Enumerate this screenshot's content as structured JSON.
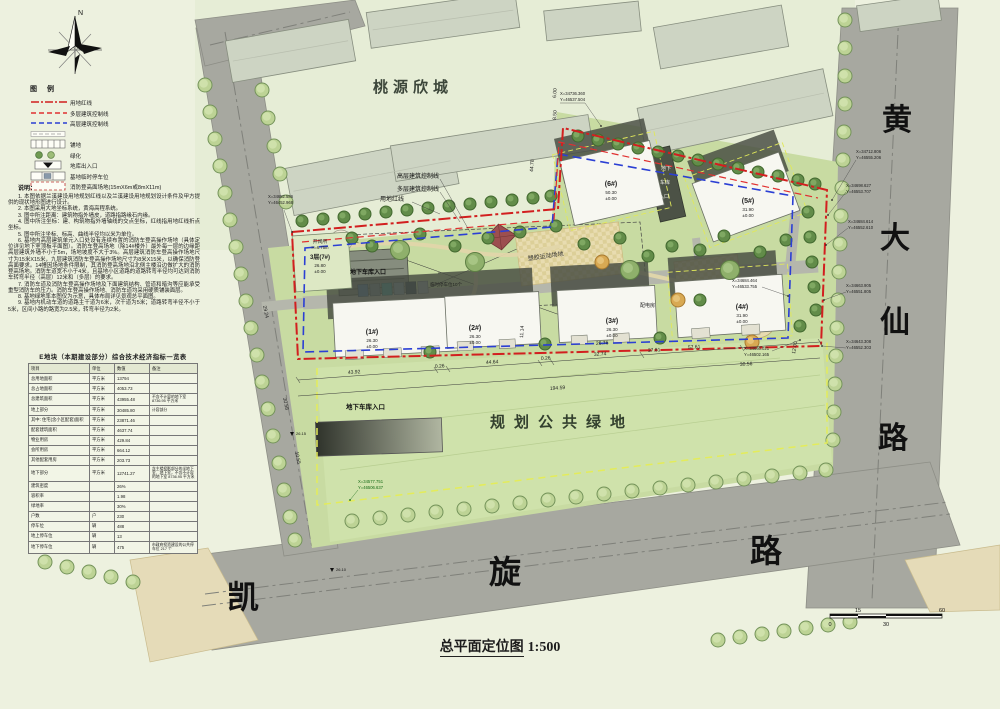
{
  "title": {
    "text": "总平面定位图",
    "scale": "1:500"
  },
  "compass": {
    "north": "N"
  },
  "scalebar": {
    "labels": [
      "0",
      "15",
      "30",
      "60"
    ]
  },
  "legend": {
    "title": "图 例",
    "items": [
      {
        "label": "用地红线",
        "type": "red-dashdot"
      },
      {
        "label": "多层建筑控制线",
        "type": "red-dash"
      },
      {
        "label": "高层建筑控制线",
        "type": "blue-dash"
      },
      {
        "label": "",
        "type": "grey-line"
      },
      {
        "label": "铺地",
        "type": "hatch"
      },
      {
        "label": "绿化",
        "type": "green"
      },
      {
        "label": "地库出入口",
        "type": "entry"
      },
      {
        "label": "基地临时停车位",
        "type": "parking"
      },
      {
        "label": "消防登高面场地(15mX6m或8mX11m)",
        "type": "fire"
      }
    ]
  },
  "notes": {
    "title": "说明：",
    "lines": [
      "1. 本图依据兰溪建设用地规划红线以及兰溪建设用地规划设计条件及甲方提供的现状地形图进行设计。",
      "2. 本图采用大地坐标系统，黄海高程系统。",
      "3. 图中所注距离：建筑物指外墙皮，道路指路缘石内缘。",
      "4. 图中所注坐标：建、构筑物指外墙轴线的交点坐标，红线指用地红线折点坐标。",
      "5. 图中所注坐标、标高、曲线半径均以米为单位。",
      "6. 基地内高层建筑单元入口处设有连续布置的消防车登高操作场地（具体定位详见地下室顶板平面图）。消防车登高场地（除14#楼外）最外每一层的边缘距高层建筑外墙不小于5m，场地坡度不大于3%。高层建筑消防车登高操作场地尺寸为15米X15米，九层建筑消防车登高操作场地尺寸为8米X15米，以确保消防登高面要求。14幢因场地条件限制，其消防登高场地沿北侧主楼沿边做扩大的消防登高场地。消防车道宽不小于4米，且基地小区道路的道路转弯半径均可达到消防车转弯半径（高层）12米和（多层）的要求。",
      "7. 消防车道及消防车登高操作场地及下面建筑结构、管道和暗沟等应能承受重型消防车的压力。消防车登高操作场地、消防车道均采用硬质铺装面层。",
      "8. 基地绿地率本图仅为示意，具体布局详见景观总平面图。",
      "9. 基地内机动车道的道路主干道为6米，次干道为5米；道路转弯半径不小于5米，区间小路的路宽为2.5米，转弯半径为2米。"
    ]
  },
  "table": {
    "title": "E地块（本期建设部分）综合技术经济指标一览表",
    "headers": [
      "项目",
      "单位",
      "数值",
      "备注"
    ],
    "rows": [
      {
        "name": "总用地面积",
        "unit": "平方米",
        "value": "13794",
        "remark": ""
      },
      {
        "name": "总占地面积",
        "unit": "平方米",
        "value": "4053.73",
        "remark": ""
      },
      {
        "name": "总建筑面积",
        "unit": "平方米",
        "value": "43955.48",
        "remark": "不含不计容的地下室 8736.95 平方米"
      },
      {
        "name": "地上部分",
        "unit": "平方米",
        "value": "30485.80",
        "remark": "计容部分"
      },
      {
        "name": "其中: 住宅(含小区配套)面积",
        "unit": "平方米",
        "value": "23871.46",
        "remark": ""
      },
      {
        "name": "配套建筑面积",
        "unit": "平方米",
        "value": "4637.74",
        "remark": ""
      },
      {
        "name": "物业用房",
        "unit": "平方米",
        "value": "429.84",
        "remark": ""
      },
      {
        "name": "会所用房",
        "unit": "平方米",
        "value": "664.12",
        "remark": ""
      },
      {
        "name": "其他配套用房",
        "unit": "平方米",
        "value": "203.73",
        "remark": ""
      },
      {
        "name": "地下部分",
        "unit": "平方米",
        "value": "12741.27",
        "remark": "含主楼投影部分的半地下室、地下室，不含不计容的地下室 8736.95 平方米"
      },
      {
        "name": "建筑密度",
        "unit": "",
        "value": "26%",
        "remark": ""
      },
      {
        "name": "容积率",
        "unit": "",
        "value": "1.98",
        "remark": ""
      },
      {
        "name": "绿地率",
        "unit": "",
        "value": "30%",
        "remark": ""
      },
      {
        "name": "户数",
        "unit": "户",
        "value": "230",
        "remark": ""
      },
      {
        "name": "停车位",
        "unit": "辆",
        "value": "488",
        "remark": ""
      },
      {
        "name": "地上停车位",
        "unit": "辆",
        "value": "13",
        "remark": ""
      },
      {
        "name": "地下停车位",
        "unit": "辆",
        "value": "475",
        "remark": "市政府投资建设的公共停车位 217 个"
      }
    ]
  },
  "plan": {
    "labels": {
      "taoyuan": "桃源欣城",
      "public_green": "规划公共绿地",
      "garage1": "地下车库入口",
      "garage2": "地下车库入口",
      "garage3a": "地下",
      "garage3b": "车库",
      "garage3c": "入口",
      "sports": "塑胶运动场地",
      "temp_parking": "临时停车位10个",
      "power_room": "配电房",
      "switch_station": "开闭所",
      "switch_height": "H=6.75m"
    },
    "line_labels": {
      "highrise": "高层建筑控制线",
      "multistorey": "多层建筑控制线",
      "redline": "用地红线"
    },
    "buildings": [
      {
        "no": "(1#)",
        "elev": "26.30",
        "base": "±0.00"
      },
      {
        "no": "(2#)",
        "elev": "26.30",
        "base": "±0.00"
      },
      {
        "no": "(3#)",
        "elev": "26.30",
        "base": "±0.00"
      },
      {
        "no": "(4#)",
        "elev": "31.90",
        "base": "±0.00"
      },
      {
        "no": "(5#)",
        "elev": "31.90",
        "base": "±0.00"
      },
      {
        "no": "(6#)",
        "elev": "50.30",
        "base": "±0.00"
      },
      {
        "no": "3层(7#)",
        "elev": "26.80",
        "base": "±0.00"
      }
    ],
    "roads": {
      "huangdaxian": [
        "黄",
        "大",
        "仙",
        "路"
      ],
      "kaixuan": [
        "凯",
        "旋",
        "路"
      ]
    },
    "coords": {
      "c0": {
        "x": "X=34736.360",
        "y": "Y=46537.504"
      },
      "c1": {
        "x": "X=34712.806",
        "y": "Y=46555.206"
      },
      "c2": {
        "x": "X=34698.627",
        "y": "Y=46553.707"
      },
      "c3": {
        "x": "X=34684.614",
        "y": "Y=46552.610"
      },
      "c4": {
        "x": "X=34663.905",
        "y": "Y=46551.805"
      },
      "c5": {
        "x": "X=34643.308",
        "y": "Y=46552.303"
      },
      "c6": {
        "x": "X=34684.464",
        "y": "Y=46533.755"
      },
      "c7": {
        "x": "X=34666.021",
        "y": "Y=46502.165"
      },
      "c8": {
        "x": "X=34577.751",
        "y": "Y=46506.637"
      },
      "c9": {
        "x": "X=34682.586",
        "y": "Y=46452.968"
      }
    },
    "dims": {
      "d1": "43.92",
      "d2": "0.26",
      "d3": "44.64",
      "d4": "0.26",
      "d5": "32.74",
      "d6": "57.61",
      "d7": "194.59",
      "d8": "44.78",
      "d9": "26.76",
      "d10": "11.14",
      "d11": "37.81",
      "d12": "29.24",
      "d13": "30.58",
      "d14": "10.55",
      "d15": "8.50",
      "d16": "6.00",
      "d17": "12.00",
      "d18": "30.56"
    },
    "levels": {
      "l1": "26.15",
      "l2": "26.10"
    }
  }
}
